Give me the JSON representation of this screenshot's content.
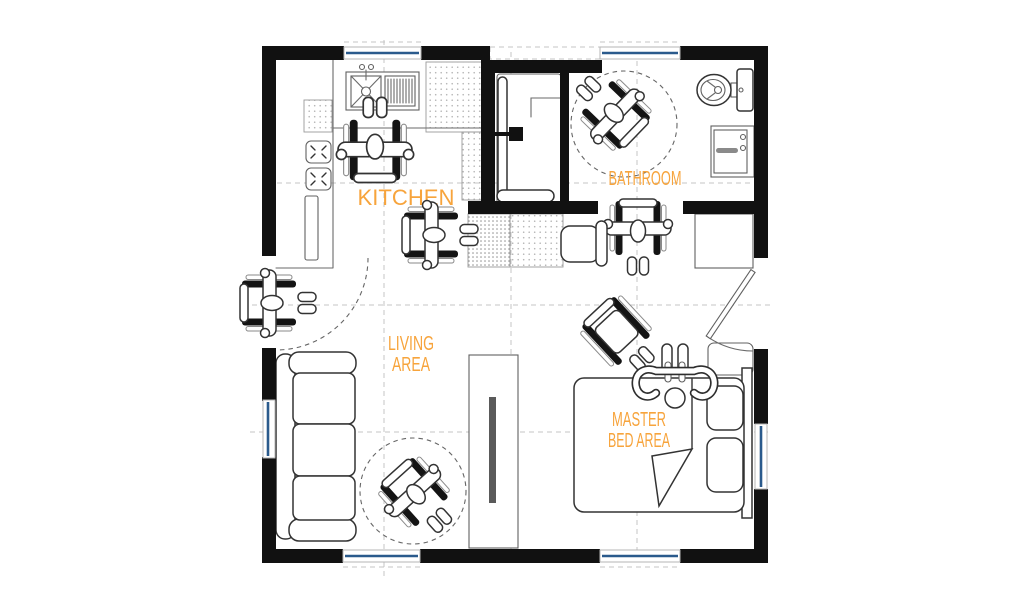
{
  "image": {
    "type": "architectural-floor-plan",
    "description": "Wheelchair-accessible studio apartment floor plan, top view"
  },
  "colors": {
    "background": "#ffffff",
    "wall": "#111111",
    "line": "#333333",
    "label": "#F7A43C",
    "window": "#2A5A8C",
    "guide": "#c4c4c4",
    "tv": "#5a5a5a"
  },
  "rooms": [
    {
      "id": "kitchen",
      "label": "KITCHEN"
    },
    {
      "id": "bathroom",
      "label": "BATHROOM"
    },
    {
      "id": "living-area",
      "label_line1": "LIVING",
      "label_line2": "AREA"
    },
    {
      "id": "master-bed-area",
      "label_line1": "MASTER",
      "label_line2": "BED AREA"
    }
  ],
  "fixtures": [
    "kitchen-sink",
    "drainboard",
    "cooktop",
    "kitchen-counter",
    "tall-cabinet",
    "shower-enclosure",
    "shower-door",
    "shower-head",
    "shower-bench",
    "toilet",
    "vanity-sink",
    "dresser",
    "nightstand",
    "desk",
    "desk-chair",
    "sofa",
    "tv-cabinet",
    "tv-screen",
    "bed",
    "pillow",
    "pillow",
    "duvet-fold",
    "headboard",
    "entry-door-swing",
    "terrace-door"
  ],
  "accessibility": {
    "wheelchair_users": 6,
    "empty_wheelchairs": 1,
    "person_transferring_to_bed": 1,
    "turning_circles": 2
  },
  "openings": {
    "windows": 6,
    "doors": 2
  }
}
